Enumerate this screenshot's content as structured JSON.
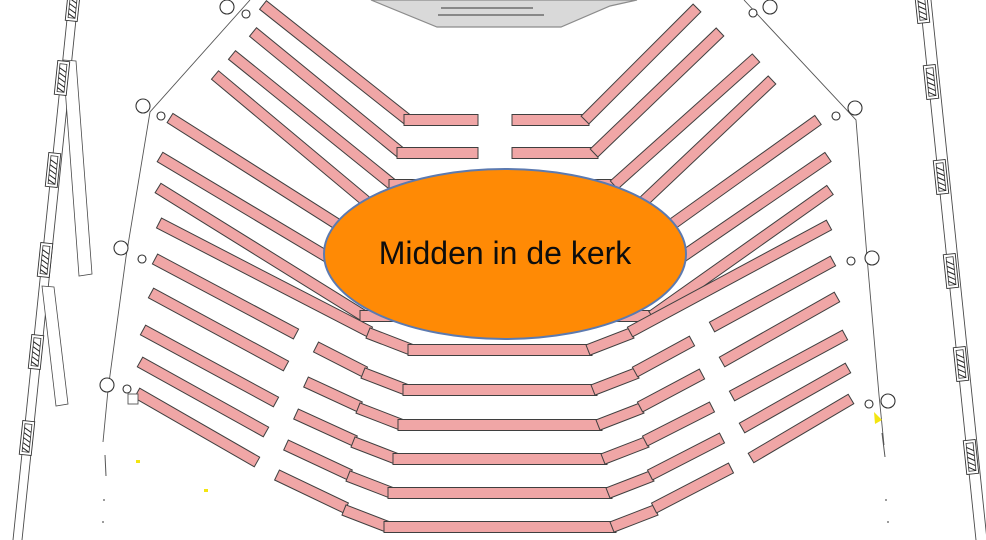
{
  "annotation": {
    "label": "Midden in de kerk"
  },
  "colors": {
    "pew_fill": "#f0a6a6",
    "pew_stroke": "#3f3f3f",
    "ellipse_fill": "#ff8a05",
    "ellipse_stroke": "#5c7ab0",
    "podium_fill": "#d9d9d9",
    "podium_stroke": "#8c8c8c",
    "wall_stroke": "#4a4a4a",
    "floor": "#ffffff",
    "mark_yellow": "#f3e511"
  },
  "floorplan": {
    "canvas": {
      "w": 986,
      "h": 540
    },
    "pew_band_width": 11,
    "pew_segments": [
      [
        263,
        5,
        408,
        120
      ],
      [
        404,
        120,
        478,
        120
      ],
      [
        512,
        120,
        589,
        120
      ],
      [
        585,
        120,
        697,
        8
      ],
      [
        253,
        32,
        401,
        153
      ],
      [
        397,
        153,
        478,
        153
      ],
      [
        512,
        153,
        598,
        153
      ],
      [
        594,
        153,
        720,
        32
      ],
      [
        232,
        55,
        393,
        185
      ],
      [
        389,
        185,
        618,
        185
      ],
      [
        614,
        185,
        756,
        58
      ],
      [
        215,
        75,
        386,
        218
      ],
      [
        382,
        218,
        630,
        218
      ],
      [
        626,
        218,
        772,
        80
      ],
      [
        170,
        118,
        378,
        250
      ],
      [
        374,
        250,
        640,
        250
      ],
      [
        636,
        250,
        818,
        120
      ],
      [
        160,
        157,
        371,
        283
      ],
      [
        367,
        283,
        648,
        283
      ],
      [
        644,
        283,
        828,
        157
      ],
      [
        158,
        188,
        364,
        316
      ],
      [
        360,
        316,
        656,
        316
      ],
      [
        652,
        316,
        830,
        190
      ],
      [
        159,
        223,
        370,
        332
      ],
      [
        368,
        333,
        412,
        350
      ],
      [
        408,
        350,
        592,
        350
      ],
      [
        588,
        350,
        632,
        333
      ],
      [
        630,
        332,
        829,
        225
      ],
      [
        155,
        259,
        296,
        334
      ],
      [
        316,
        347,
        365,
        372
      ],
      [
        363,
        373,
        407,
        390
      ],
      [
        403,
        390,
        597,
        390
      ],
      [
        593,
        390,
        637,
        373
      ],
      [
        635,
        372,
        692,
        341
      ],
      [
        712,
        327,
        833,
        261
      ],
      [
        151,
        293,
        286,
        366
      ],
      [
        306,
        382,
        360,
        407
      ],
      [
        358,
        408,
        402,
        425
      ],
      [
        398,
        425,
        602,
        425
      ],
      [
        598,
        425,
        642,
        408
      ],
      [
        640,
        407,
        702,
        374
      ],
      [
        722,
        362,
        837,
        297
      ],
      [
        143,
        330,
        276,
        402
      ],
      [
        296,
        414,
        355,
        441
      ],
      [
        353,
        442,
        397,
        459
      ],
      [
        393,
        459,
        607,
        459
      ],
      [
        603,
        459,
        647,
        442
      ],
      [
        645,
        441,
        712,
        407
      ],
      [
        732,
        396,
        845,
        335
      ],
      [
        140,
        362,
        266,
        432
      ],
      [
        286,
        445,
        350,
        475
      ],
      [
        348,
        476,
        392,
        493
      ],
      [
        388,
        493,
        612,
        493
      ],
      [
        608,
        493,
        652,
        476
      ],
      [
        650,
        475,
        722,
        438
      ],
      [
        742,
        428,
        848,
        368
      ],
      [
        137,
        393,
        257,
        462
      ],
      [
        277,
        475,
        346,
        508
      ],
      [
        344,
        510,
        388,
        527
      ],
      [
        384,
        527,
        616,
        527
      ],
      [
        612,
        527,
        656,
        510
      ],
      [
        654,
        508,
        731,
        468
      ],
      [
        751,
        458,
        851,
        399
      ]
    ],
    "podium": {
      "outline": "371,0 437,27 561,27 610,6 637,0",
      "lines": [
        [
          441,
          8,
          533,
          8
        ],
        [
          438,
          15,
          544,
          15
        ]
      ]
    },
    "ellipse": {
      "cx": 505,
      "cy": 254,
      "rx": 181,
      "ry": 85
    },
    "walls": {
      "left_lines": [
        [
          69,
          0,
          13,
          540
        ],
        [
          78,
          0,
          22,
          540
        ]
      ],
      "right_lines": [
        [
          920,
          0,
          976,
          540
        ],
        [
          931,
          0,
          987,
          540
        ]
      ],
      "left_panels": [
        [
          63,
          60,
          76,
          61,
          92,
          274,
          79,
          276
        ],
        [
          42,
          286,
          54,
          287,
          68,
          404,
          56,
          406
        ]
      ],
      "left_hatch": [
        [
          73,
          4,
          6
        ],
        [
          62,
          78,
          6
        ],
        [
          53,
          170,
          6
        ],
        [
          45,
          260,
          6
        ],
        [
          36,
          352,
          6
        ],
        [
          27,
          438,
          6
        ]
      ],
      "right_hatch": [
        [
          922,
          6,
          -6
        ],
        [
          931,
          82,
          -6
        ],
        [
          941,
          177,
          -6
        ],
        [
          951,
          271,
          -6
        ],
        [
          961,
          364,
          -6
        ],
        [
          971,
          457,
          -6
        ]
      ]
    },
    "boundaries": {
      "left_poly": "250,0 150,112 126,257 108,390 103,442",
      "right_poly": "744,0 856,120 867,257 879,395 884,445",
      "dashes": [
        [
          105,
          455,
          106,
          476
        ],
        [
          882,
          433,
          885,
          457
        ]
      ],
      "dots": [
        [
          104,
          500
        ],
        [
          103,
          522
        ],
        [
          886,
          500
        ],
        [
          888,
          522
        ]
      ]
    },
    "pillar_circles": [
      [
        227,
        7,
        7
      ],
      [
        246,
        14,
        4
      ],
      [
        143,
        106,
        7
      ],
      [
        161,
        116,
        4
      ],
      [
        121,
        248,
        7
      ],
      [
        142,
        259,
        4
      ],
      [
        107,
        385,
        7
      ],
      [
        127,
        389,
        4
      ],
      [
        770,
        7,
        7
      ],
      [
        753,
        13,
        4
      ],
      [
        855,
        108,
        7
      ],
      [
        836,
        116,
        4
      ],
      [
        872,
        258,
        7
      ],
      [
        851,
        261,
        4
      ],
      [
        888,
        401,
        7
      ],
      [
        869,
        404,
        4
      ]
    ],
    "small_rects": [
      [
        128,
        394,
        10,
        10
      ]
    ],
    "yellow_marks": {
      "triangles": [
        [
          874,
          412,
          882,
          420,
          875,
          424
        ]
      ],
      "dots": [
        [
          204,
          489
        ],
        [
          136,
          460
        ]
      ]
    }
  }
}
